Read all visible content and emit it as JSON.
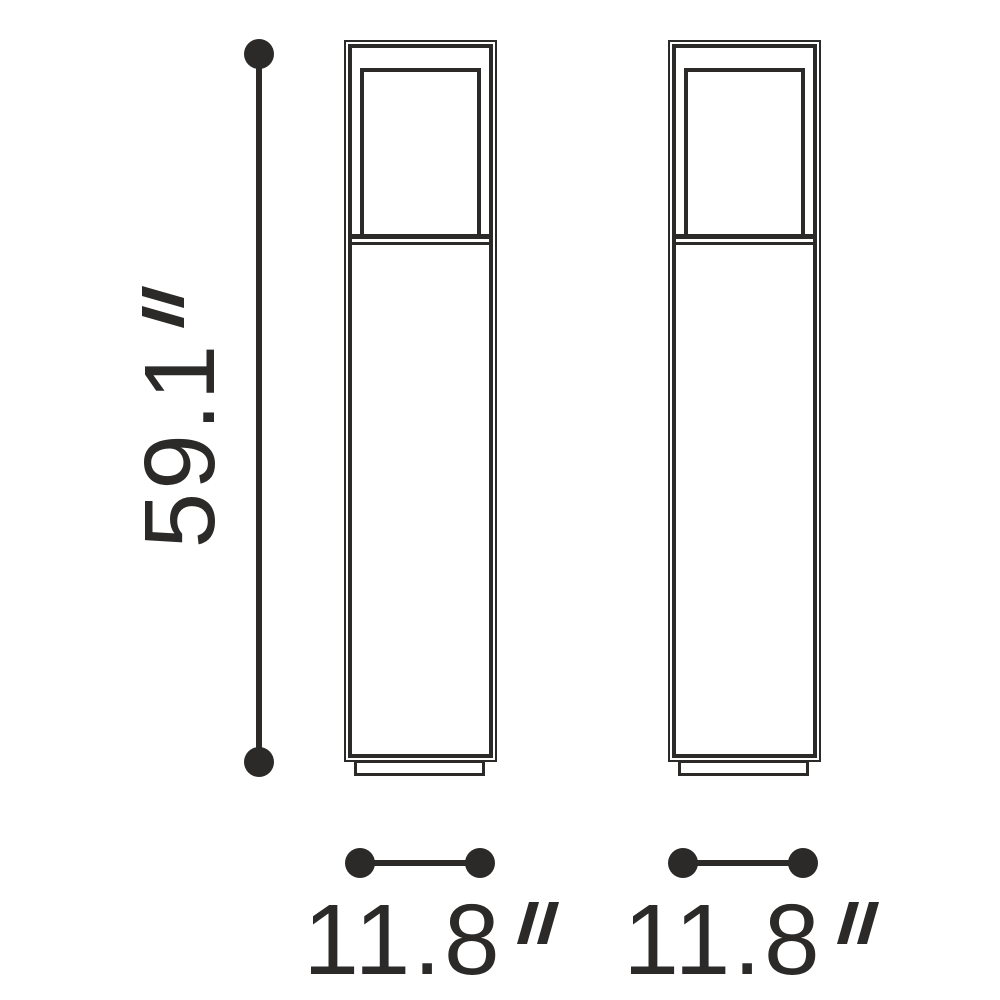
{
  "diagram_title": "product-dimension-drawing",
  "colors": {
    "ink": "#2b2a29",
    "background": "#ffffff"
  },
  "views": [
    {
      "name": "front-view"
    },
    {
      "name": "side-view"
    }
  ],
  "dimensions": {
    "height": {
      "value": "59.1",
      "unit": "″"
    },
    "width_front": {
      "value": "11.8",
      "unit": "″"
    },
    "width_side": {
      "value": "11.8",
      "unit": "″"
    }
  }
}
